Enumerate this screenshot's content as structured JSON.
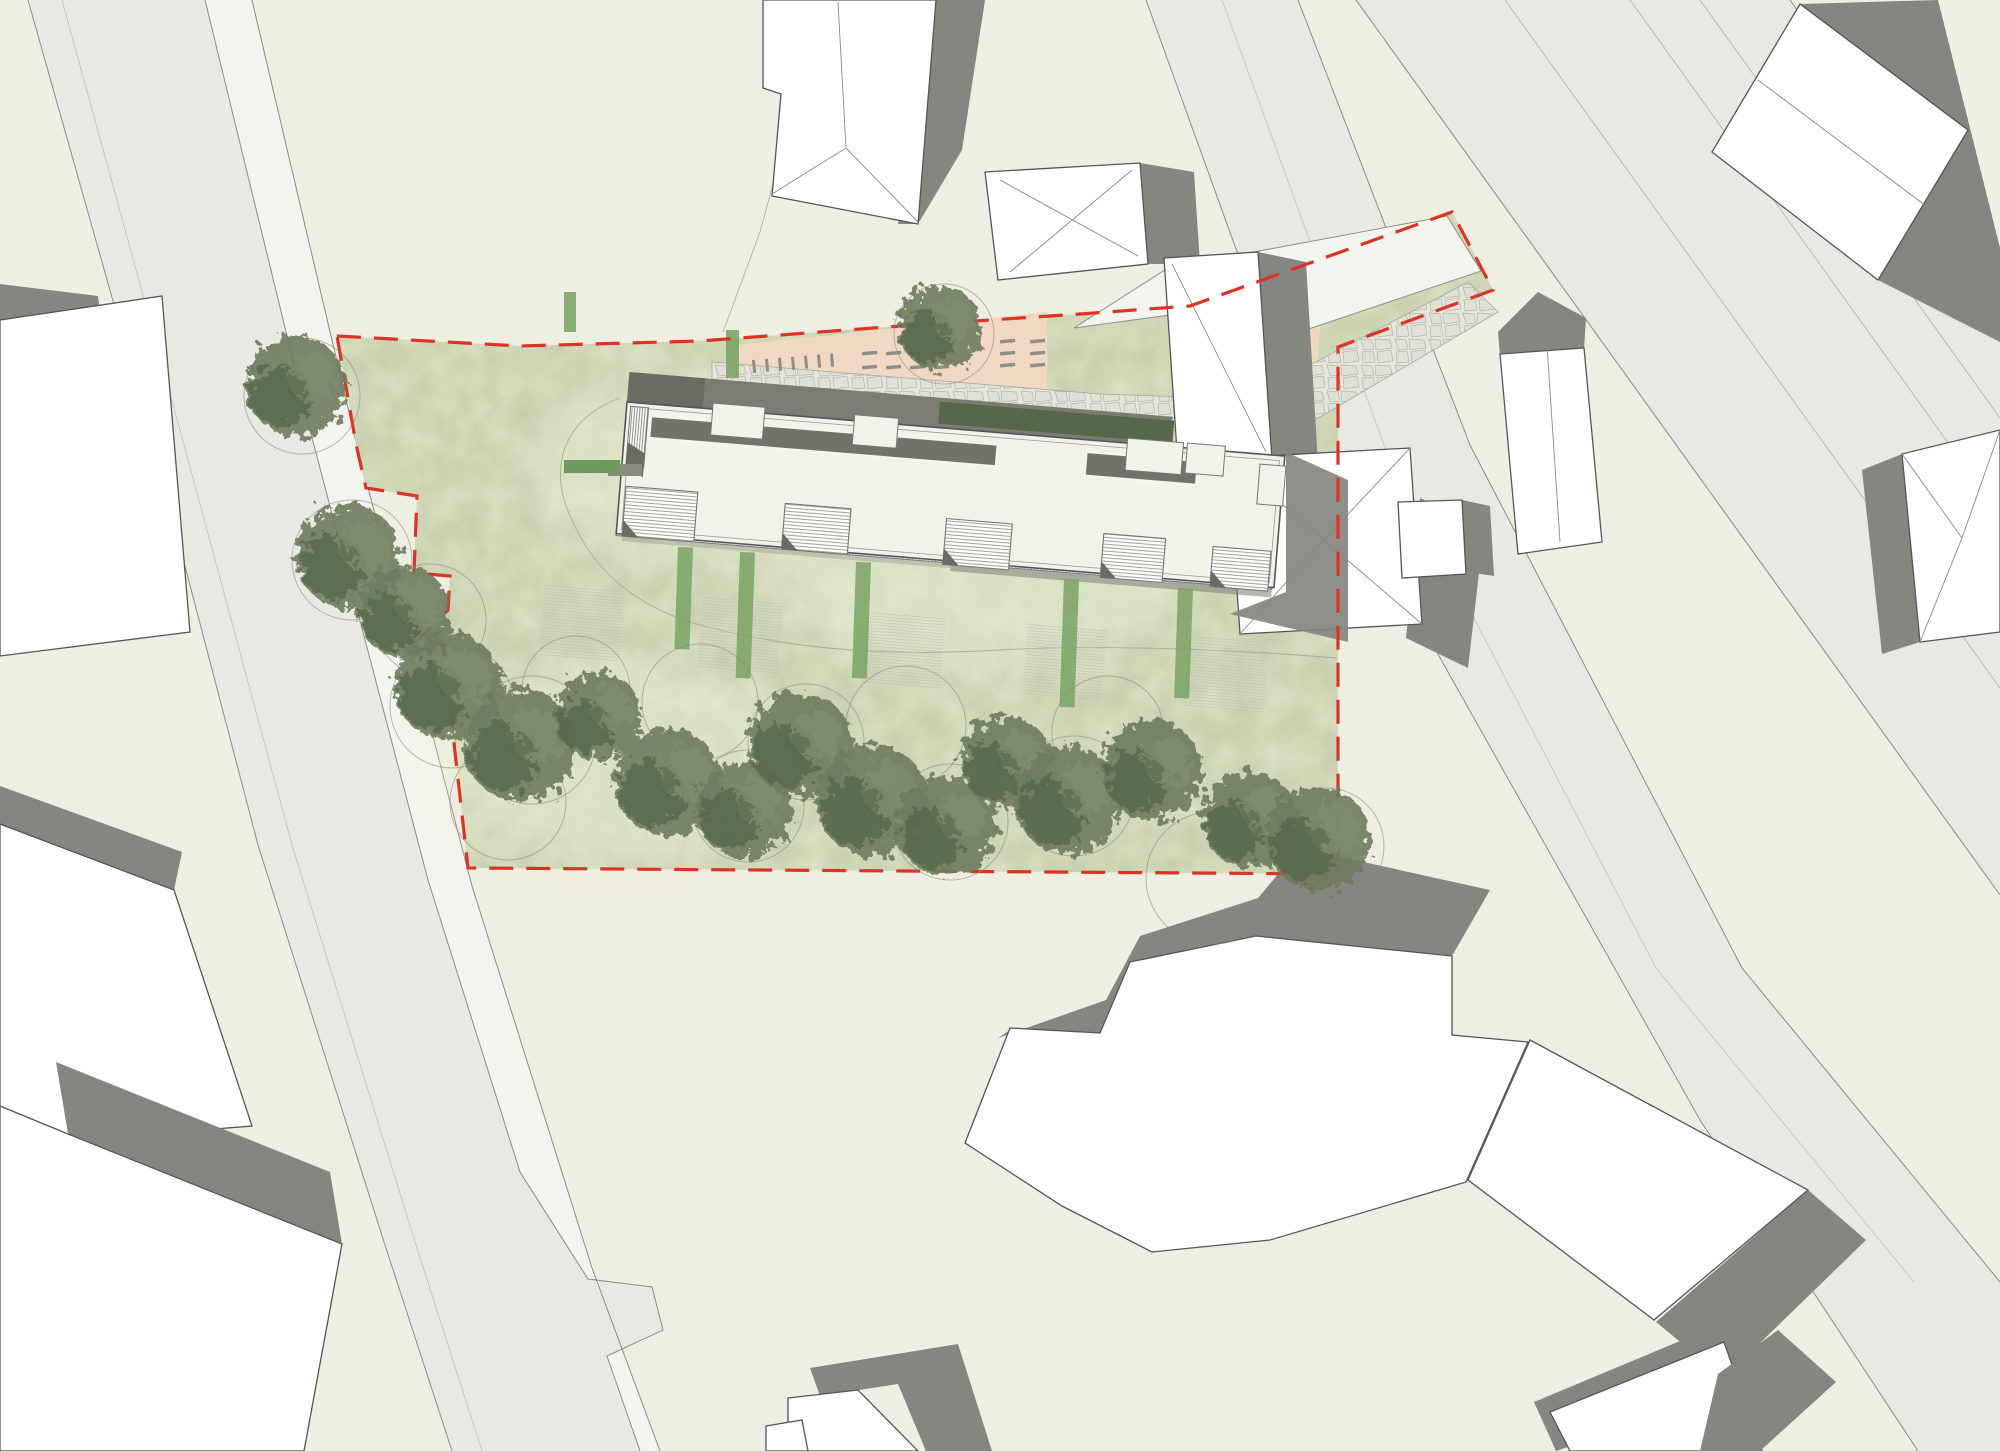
{
  "document": {
    "kind": "architectural site plan (top view rendering)",
    "aria_label": "Architectural site plan with red dashed property boundary, long residential building, parking strip, lawn and tree rows, surrounded by roads and neighbouring buildings",
    "visible_text": []
  },
  "colors": {
    "background": "#efeee2",
    "road": "#e9e9e3",
    "sidewalk": "#f4f4ee",
    "road_edge": "#8d8d87",
    "lawn": "#dde3c4",
    "lawn_noise": "0 0 0 0 0.35  0 0 0 0 0.42  0 0 0 0 0.25  0 0 0 0.45 0",
    "lawn_light": "#e9edd4",
    "boundary_red": "#d93425",
    "building_white": "#ffffff",
    "building_outline": "#55555a",
    "roof_line": "#8a8a86",
    "shadow": "#868680",
    "roof": "#f3f2e8",
    "walk_dark": "#7c7c74",
    "wing_dark": "#6b6b64",
    "gallery": "#72726b",
    "hedge_dark": "#55684a",
    "hedge_light": "#7ca465",
    "hedge_patch_green": "#6f9a5e",
    "hedge_patch_gray": "#8a8a82",
    "cobble_bg": "#e6e6dd",
    "cobble_line": "#b5b5ab",
    "peach": "#f1d8c3",
    "driveway": "#f4f4ee",
    "mark": "#8e8e86",
    "tree_main": "#6d7c5d",
    "tree_dark": "#57684a",
    "tree_light": "#808d6d",
    "canopy_circle": "#87877f",
    "path_line": "#9b9b93"
  },
  "roads": {
    "left_fill": "28,0 205,0 310,430 428,880 520,1172 588,1279 652,1287 663,1330 607,1356 640,1451 452,1451 385,1245 258,845 148,425",
    "left_sidewalk": "205,0 252,0 355,438 472,886 592,1268 660,1451 640,1451 607,1356 663,1330 652,1287 588,1279 520,1172 428,880 310,430",
    "left_edges": [
      "28,0 148,425 258,845 385,1245 452,1451",
      "205,0 310,430 428,880 520,1172 588,1279 652,1287 663,1330 607,1356 640,1451",
      "252,0 355,438 472,886 592,1268 660,1451"
    ],
    "left_lane": "62,0 180,430 292,845 416,1245 482,1451",
    "rightA_fill": "1146,0 1298,0 1470,445 1742,968 2000,1282 2000,1451 1918,1451 1700,1120 1430,640 1240,260",
    "rightA_edges": [
      "1146,0 1240,260 1430,640 1700,1120 1918,1451",
      "1298,0 1470,445 1742,968 2000,1282"
    ],
    "rightA_lane": "1222,0 1384,445 1656,968 1914,1282",
    "rightB_fill": "1356,0 1790,0 2000,292 2000,895",
    "rightB_edges": [
      "1356,0 2000,895",
      "1790,0 2000,292"
    ],
    "rightB_lanes": [
      "1505,0 2000,688",
      "1630,0 2000,515",
      "1700,0 2000,418"
    ]
  },
  "site": {
    "lawn_points": "337,336 520,346 700,341 900,326 1080,314 1190,306 1452,212 1493,290 1338,347 1338,874 468,868 443,645 418,640 448,610 450,576 414,573 417,496 366,488 356,444",
    "boundary_points": "337,336 520,346 700,341 900,326 1080,314 1190,306 1452,212 1493,290 1338,347 1338,874 468,868 443,645 418,640 448,610 450,576 414,573 417,496 366,488 356,444",
    "boundary_dash": "24 13",
    "light_blobs": [
      {
        "cx": 700,
        "cy": 470,
        "rx": 170,
        "ry": 90
      },
      {
        "cx": 980,
        "cy": 560,
        "rx": 210,
        "ry": 110
      },
      {
        "cx": 620,
        "cy": 760,
        "rx": 180,
        "ry": 100
      }
    ],
    "path_curve_d": "M 620,398 C 560,420 548,472 572,520 C 596,575 640,608 700,625 C 800,652 900,656 1000,650 C 1100,644 1240,650 1336,658",
    "utility_line": "800,84 760,232 723,332"
  },
  "circulation": {
    "driveway_points": "1074,328 1168,268 1447,216 1481,271 1270,342 1170,315",
    "cobble_points": "712,362 1100,394 1245,399 1468,282 1498,312 1308,424 1245,448 1100,412 712,380",
    "peach_main": "728,346 1047,312 1047,390 728,363",
    "peach_right": "1248,318 1322,300 1316,390 1250,396"
  },
  "parking_marks": {
    "vertical_ticks": {
      "x0": 752,
      "step": 13,
      "count": 7,
      "y0": 360,
      "slope": -0.08,
      "len": 13,
      "w": 3
    },
    "dash_grids": [
      {
        "cols": [
          862,
          886,
          910,
          934
        ],
        "rows": [
          352,
          366
        ],
        "w": 15,
        "h": 3.5,
        "tilt": -5
      },
      {
        "cols": [
          1000,
          1030
        ],
        "rows": [
          340,
          352,
          364
        ],
        "w": 15,
        "h": 3.5,
        "tilt": -5
      },
      {
        "cols": [
          1252,
          1282
        ],
        "rows": [
          326,
          342,
          358,
          374
        ],
        "w": 15,
        "h": 3.5,
        "tilt": -4
      }
    ]
  },
  "main_building": {
    "origin": [
      627,
      402
    ],
    "angle": 4.7,
    "length": 660,
    "width": 132,
    "walk": {
      "x": 0,
      "y": -30,
      "w": 545,
      "h": 30
    },
    "wing": {
      "x": 0,
      "y": -30,
      "w": 76,
      "h": 30
    },
    "hedge_band": {
      "x": 312,
      "y": -26,
      "w": 235,
      "h": 22
    },
    "gallery": [
      {
        "x": 25,
        "y": 12,
        "w": 348,
        "h": 22
      },
      {
        "x": 462,
        "y": 12,
        "w": 112,
        "h": 24
      }
    ],
    "notches": [
      {
        "x": 86,
        "y": -6,
        "w": 52,
        "h": 32
      },
      {
        "x": 228,
        "y": -6,
        "w": 44,
        "h": 30
      },
      {
        "x": 502,
        "y": -5,
        "w": 56,
        "h": 32
      },
      {
        "x": 562,
        "y": -5,
        "w": 38,
        "h": 30
      }
    ],
    "stair": {
      "x": 4,
      "y": 4,
      "w": 18,
      "h": 60
    },
    "stair_shadow": "4,40 22,50 22,74 4,64",
    "strip": {
      "x": 0,
      "y": 108,
      "w": 658,
      "h": 26
    },
    "strip_shadows": [
      {
        "x": 6,
        "y": 134,
        "w": 330,
        "h": 5,
        "op": 0.35
      },
      {
        "x": 336,
        "y": 134,
        "w": 322,
        "h": 8,
        "op": 0.6
      }
    ],
    "boxes": [
      {
        "x": 6,
        "y": 84,
        "w": 72,
        "h": 50
      },
      {
        "x": 166,
        "y": 88,
        "w": 66,
        "h": 46
      },
      {
        "x": 328,
        "y": 90,
        "w": 66,
        "h": 46
      },
      {
        "x": 486,
        "y": 92,
        "w": 62,
        "h": 44
      },
      {
        "x": 596,
        "y": 96,
        "w": 58,
        "h": 40
      }
    ],
    "right_notch": {
      "x": 636,
      "y": 10,
      "w": 26,
      "h": 40
    },
    "shadow_global": "1286,452 1348,480 1348,642 1230,614 1286,592"
  },
  "garden": {
    "hedge_patch_gray": {
      "x": 608,
      "y": 464,
      "w": 34,
      "h": 12
    },
    "hedge_patch_green": {
      "x": 564,
      "y": 460,
      "w": 56,
      "h": 13
    },
    "hedge_v1": {
      "x": 564,
      "y": 292,
      "w": 12,
      "h": 40
    },
    "hedge_v2": {
      "x": 726,
      "y": 330,
      "w": 13,
      "h": 48
    },
    "hedge_strips": [
      {
        "x": 678,
        "y": 547,
        "w": 15,
        "h": 102
      },
      {
        "x": 740,
        "y": 552,
        "w": 15,
        "h": 126
      },
      {
        "x": 856,
        "y": 562,
        "w": 15,
        "h": 116
      },
      {
        "x": 1064,
        "y": 579,
        "w": 15,
        "h": 128
      },
      {
        "x": 1178,
        "y": 588,
        "w": 15,
        "h": 110
      }
    ],
    "patios": [
      {
        "x": 545,
        "y": 583,
        "w": 80,
        "h": 72
      },
      {
        "x": 703,
        "y": 596,
        "w": 80,
        "h": 72
      },
      {
        "x": 866,
        "y": 610,
        "w": 80,
        "h": 72
      },
      {
        "x": 1028,
        "y": 623,
        "w": 80,
        "h": 72
      },
      {
        "x": 1190,
        "y": 636,
        "w": 80,
        "h": 72
      }
    ]
  },
  "vegetation": {
    "trees": [
      {
        "x": 296,
        "y": 386,
        "r": 50
      },
      {
        "x": 348,
        "y": 556,
        "r": 52
      },
      {
        "x": 404,
        "y": 612,
        "r": 46
      },
      {
        "x": 448,
        "y": 686,
        "r": 54
      },
      {
        "x": 520,
        "y": 745,
        "r": 56
      },
      {
        "x": 598,
        "y": 716,
        "r": 44
      },
      {
        "x": 668,
        "y": 782,
        "r": 54
      },
      {
        "x": 744,
        "y": 810,
        "r": 48
      },
      {
        "x": 800,
        "y": 744,
        "r": 52
      },
      {
        "x": 872,
        "y": 800,
        "r": 56
      },
      {
        "x": 946,
        "y": 826,
        "r": 50
      },
      {
        "x": 1006,
        "y": 762,
        "r": 46
      },
      {
        "x": 1068,
        "y": 800,
        "r": 54
      },
      {
        "x": 1152,
        "y": 770,
        "r": 50
      },
      {
        "x": 1250,
        "y": 820,
        "r": 48
      },
      {
        "x": 1318,
        "y": 838,
        "r": 52
      },
      {
        "x": 940,
        "y": 328,
        "r": 42
      }
    ],
    "canopy_circles": [
      {
        "x": 302,
        "y": 396,
        "r": 58
      },
      {
        "x": 352,
        "y": 560,
        "r": 60
      },
      {
        "x": 430,
        "y": 620,
        "r": 56
      },
      {
        "x": 452,
        "y": 706,
        "r": 62
      },
      {
        "x": 532,
        "y": 740,
        "r": 64
      },
      {
        "x": 576,
        "y": 690,
        "r": 54
      },
      {
        "x": 700,
        "y": 702,
        "r": 58
      },
      {
        "x": 748,
        "y": 806,
        "r": 56
      },
      {
        "x": 806,
        "y": 742,
        "r": 58
      },
      {
        "x": 906,
        "y": 726,
        "r": 60
      },
      {
        "x": 950,
        "y": 822,
        "r": 58
      },
      {
        "x": 1074,
        "y": 796,
        "r": 60
      },
      {
        "x": 1108,
        "y": 732,
        "r": 56
      },
      {
        "x": 1212,
        "y": 878,
        "r": 66
      },
      {
        "x": 1326,
        "y": 846,
        "r": 58
      },
      {
        "x": 944,
        "y": 334,
        "r": 50
      },
      {
        "x": 508,
        "y": 802,
        "r": 58
      }
    ]
  },
  "context_buildings": [
    {
      "name": "building-top-center",
      "shadow": "936,0 985,0 962,150 918,224 898,224",
      "white": "763,0 936,0 918,224 772,196 781,94 763,88",
      "lines": [
        "838,2 846,148",
        "846,148 918,222",
        "846,148 772,194"
      ]
    },
    {
      "name": "building-top-center-right",
      "shadow": "1140,163 1194,172 1200,264 1148,264",
      "white": "985,172 1140,163 1148,264 998,280",
      "lines": [
        "1000,180 1138,256",
        "1132,170 1010,272"
      ]
    },
    {
      "name": "building-right-upper",
      "shadow": "1258,252 1306,262 1318,464 1272,460",
      "white": "1164,258 1258,252 1272,460 1178,466",
      "lines": [
        "1172,264 1266,452"
      ]
    },
    {
      "name": "building-right-house",
      "shadow": "1420,498 1484,530 1468,668 1406,638",
      "white": "1228,458 1410,448 1422,624 1240,634",
      "lines": [
        "1228,458 1324,540",
        "1410,448 1324,540",
        "1240,634 1324,540",
        "1422,624 1324,540"
      ]
    },
    {
      "name": "building-right-house-annex",
      "shadow": "1462,500 1490,506 1494,576 1468,572",
      "white": "1398,502 1462,500 1466,574 1402,578",
      "lines": []
    },
    {
      "name": "building-top-right",
      "shadow": "1800,4 1938,0 2000,248 2000,342 1878,280 1968,130",
      "white": "1712,152 1800,4 1968,130 1878,280",
      "lines": [
        "1758,80 1926,206"
      ]
    },
    {
      "name": "building-right-edge",
      "shadow": "1862,470 1902,454 1920,642 1882,654",
      "white": "1902,454 2000,430 2000,632 1920,642",
      "lines": [
        "1902,454 1962,538",
        "1920,642 1962,538",
        "2000,430 1962,538"
      ]
    },
    {
      "name": "building-road-gable",
      "shadow": "1498,332 1538,292 1586,318 1584,350 1500,356",
      "white": "1500,354 1584,348 1602,542 1518,554",
      "lines": [
        "1544,300 1560,542"
      ]
    },
    {
      "name": "building-left-upper",
      "shadow": "0,284 98,296 103,334 0,320",
      "white": "0,320 162,296 190,632 0,656",
      "lines": []
    },
    {
      "name": "building-left-middle",
      "shadow": "0,786 182,852 174,890 0,824",
      "white": "0,824 174,890 252,1126 0,1146",
      "lines": []
    },
    {
      "name": "building-left-lower",
      "shadow": "56,1062 330,1172 342,1244 68,1134",
      "white": "68,1134 342,1244 304,1451 0,1451 0,1106",
      "lines": []
    },
    {
      "name": "building-bottom-center",
      "shadow": "810,1368 958,1344 992,1451 926,1451 898,1384 820,1396",
      "white": "788,1398 858,1390 918,1451 788,1451",
      "lines": []
    },
    {
      "name": "building-bottom-center-annex",
      "shadow": "",
      "white": "766,1426 802,1420 808,1451 766,1451",
      "lines": []
    },
    {
      "name": "building-bottom-right-large",
      "shadow": "998,1038 1106,1000 1140,936 1258,898 1300,848 1490,890 1452,956 1256,936 1130,962 1100,1034 1010,1030",
      "white": "965,1143 1010,1028 1100,1033 1130,962 1256,936 1452,956 1452,1035 1528,1042 1466,1182 1270,1240 1152,1252 1062,1206",
      "lines": []
    },
    {
      "name": "building-bottom-right-corner",
      "shadow": "1808,1190 1866,1240 1724,1378 1656,1322",
      "white": "1530,1040 1808,1190 1654,1320 1468,1180",
      "lines": []
    },
    {
      "name": "building-bottom-right-lower",
      "shadow": "1534,1402 1716,1326 1738,1390 1556,1451",
      "white": "1550,1412 1724,1342 1762,1451 1570,1451",
      "lines": []
    },
    {
      "name": "building-bottom-right-band",
      "shadow": "1718,1374 1778,1330 1836,1382 1760,1451 1700,1451",
      "white": "",
      "lines": []
    }
  ]
}
